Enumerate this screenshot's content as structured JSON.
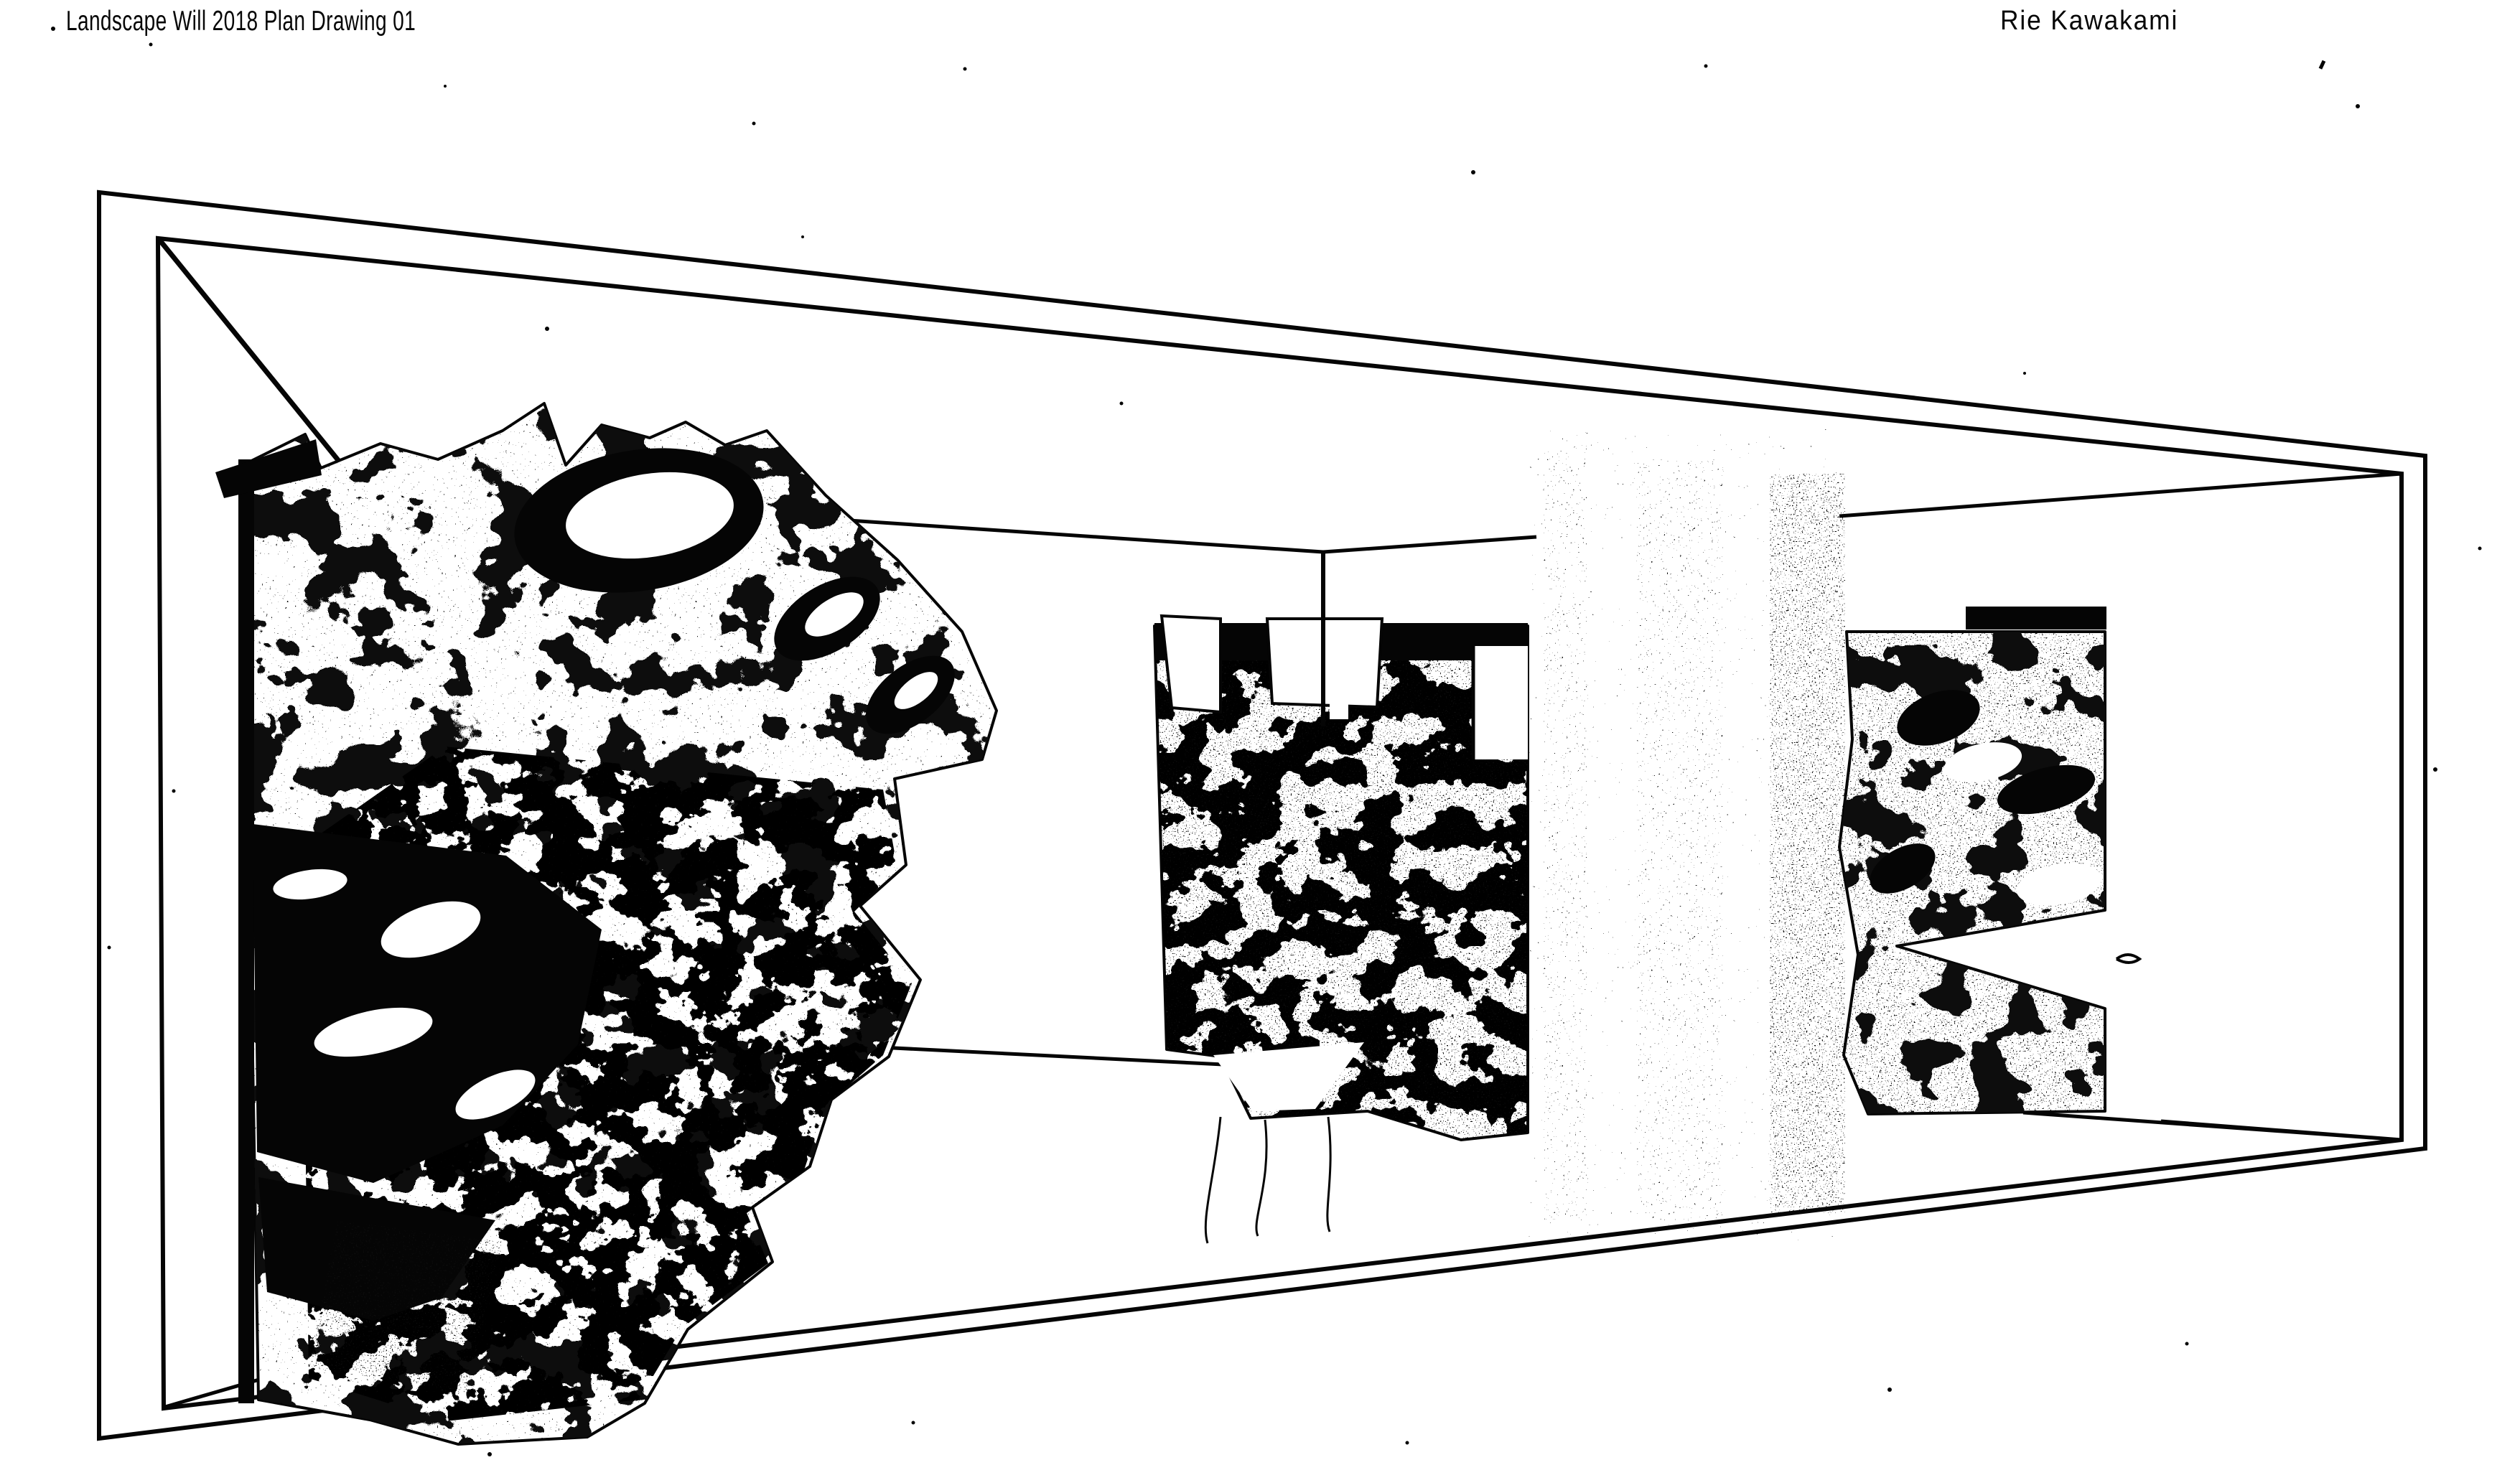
{
  "document": {
    "title": "Landscape Will 2018 Plan Drawing 01",
    "artist": "Rie Kawakami"
  },
  "drawing": {
    "type": "scanned black-and-white perspective plan drawing",
    "room": "trapezoidal perspective frame of a long gallery interior",
    "structures": [
      "left organic mesh structure",
      "middle organic mesh structure",
      "right organic mesh structure"
    ],
    "artifacts": [
      "vertical scanner smudge bands",
      "dust specks"
    ]
  },
  "colors": {
    "ink": "#050505",
    "paper": "#ffffff"
  }
}
